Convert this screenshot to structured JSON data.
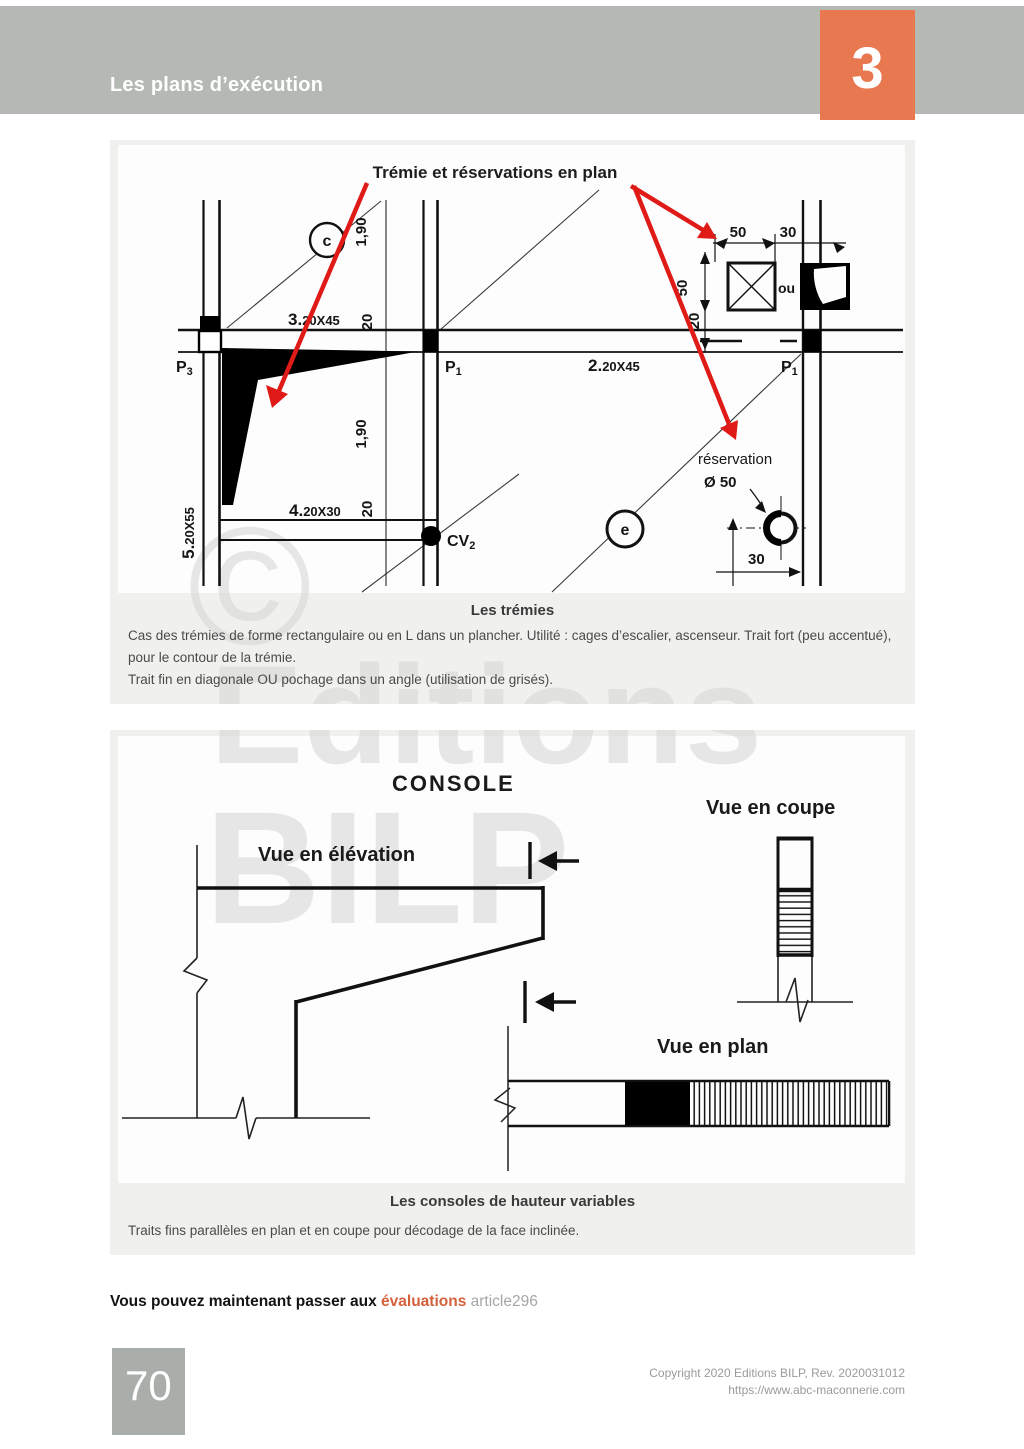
{
  "page": {
    "header": {
      "title": "Les plans d’exécution",
      "chapter_number": "3"
    },
    "colors": {
      "header_bar": "#b4b9b3",
      "accent_orange": "#e8784f",
      "red_arrow": "#df1a17",
      "block_bg": "#f0f0ee",
      "page_box": "#a9aeaa"
    },
    "watermark": {
      "copyright_symbol": "©",
      "line1": "Editions",
      "line2": "BILP"
    },
    "cta": {
      "prefix": "Vous pouvez maintenant passer aux ",
      "link": "évaluations",
      "suffix": " article296"
    },
    "footer": {
      "page_number": "70",
      "copyright_line1": "Copyright 2020 Editions BILP, Rev. 2020031012",
      "copyright_line2": "https://www.abc-maconnerie.com"
    }
  },
  "figure1": {
    "title": "Trémie et réservations en plan",
    "caption_title": "Les trémies",
    "caption_line1": "Cas des trémies de forme rectangulaire ou en L dans un plancher. Utilité : cages d’escalier, ascenseur. Trait fort (peu accentué),",
    "caption_line2": "pour le contour de la trémie.",
    "caption_line3": " Trait fin en diagonale OU pochage dans un angle (utilisation de grisés).",
    "labels": {
      "axis_c": "c",
      "axis_e": "e",
      "beam3_num": "3.",
      "beam3_dims": "20X45",
      "beam2_num": "2.",
      "beam2_dims": "20X45",
      "beam4_num": "4.",
      "beam4_dims": "20X30",
      "beam5_num": "5.",
      "beam5_dims": "20X55",
      "dim20_top": "20",
      "dim20_mid": "20",
      "dim190_top": "1,90",
      "dim190_bottom": "1,90",
      "p3_name": "P",
      "p3_sub": "3",
      "p1a_name": "P",
      "p1a_sub": "1",
      "p1b_name": "P",
      "p1b_sub": "1",
      "cv2_name": "CV",
      "cv2_sub": "2",
      "dim50_top": "50",
      "dim30_top": "30",
      "dim50_side": "50",
      "dim20_side": "20",
      "ou": "ou",
      "reservation": "réservation",
      "diameter": "Ø 50",
      "dim30_bottom": "30"
    }
  },
  "figure2": {
    "caption_title": "Les consoles de hauteur variables",
    "caption_line1": "Traits fins parallèles en plan et en coupe pour décodage de la face inclinée.",
    "labels": {
      "console": "CONSOLE",
      "vue_coupe": "Vue en coupe",
      "vue_elevation": "Vue en élévation",
      "vue_plan": "Vue en plan"
    }
  }
}
